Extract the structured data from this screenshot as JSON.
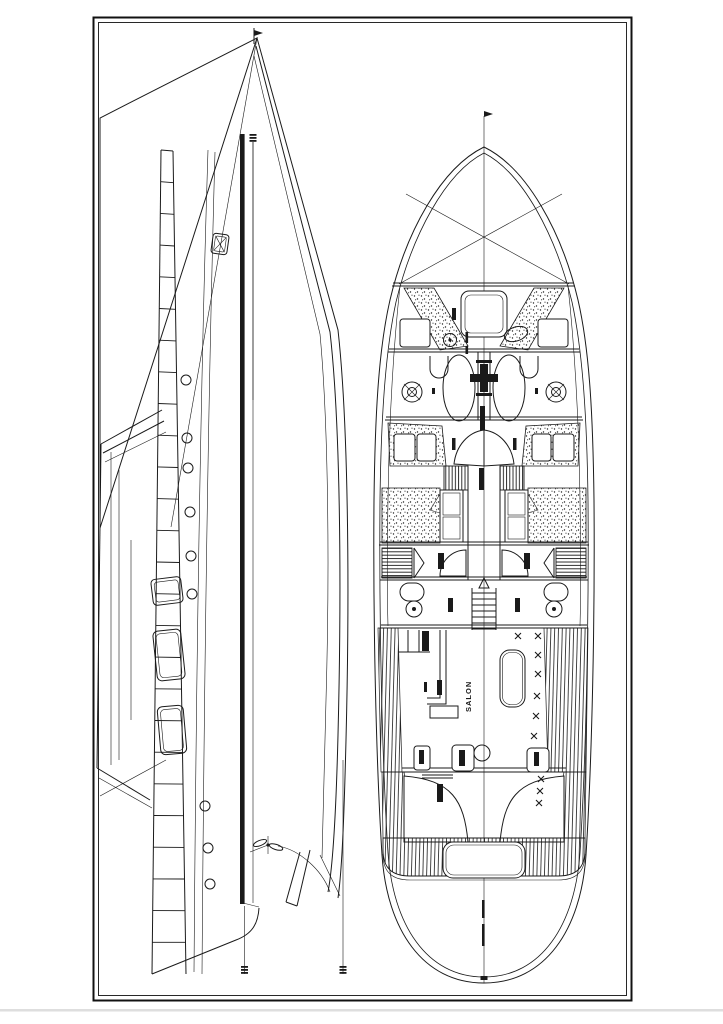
{
  "figure": {
    "type": "technical line drawing",
    "subject": "sailing yacht general arrangement: side profile view (left) and deck accommodation plan (right)"
  },
  "colors": {
    "background": "#ffffff",
    "line": "#1a1a1a",
    "frame": "#111111",
    "page_shadow": "#dedede"
  },
  "labels": {
    "salon": "SALON"
  }
}
